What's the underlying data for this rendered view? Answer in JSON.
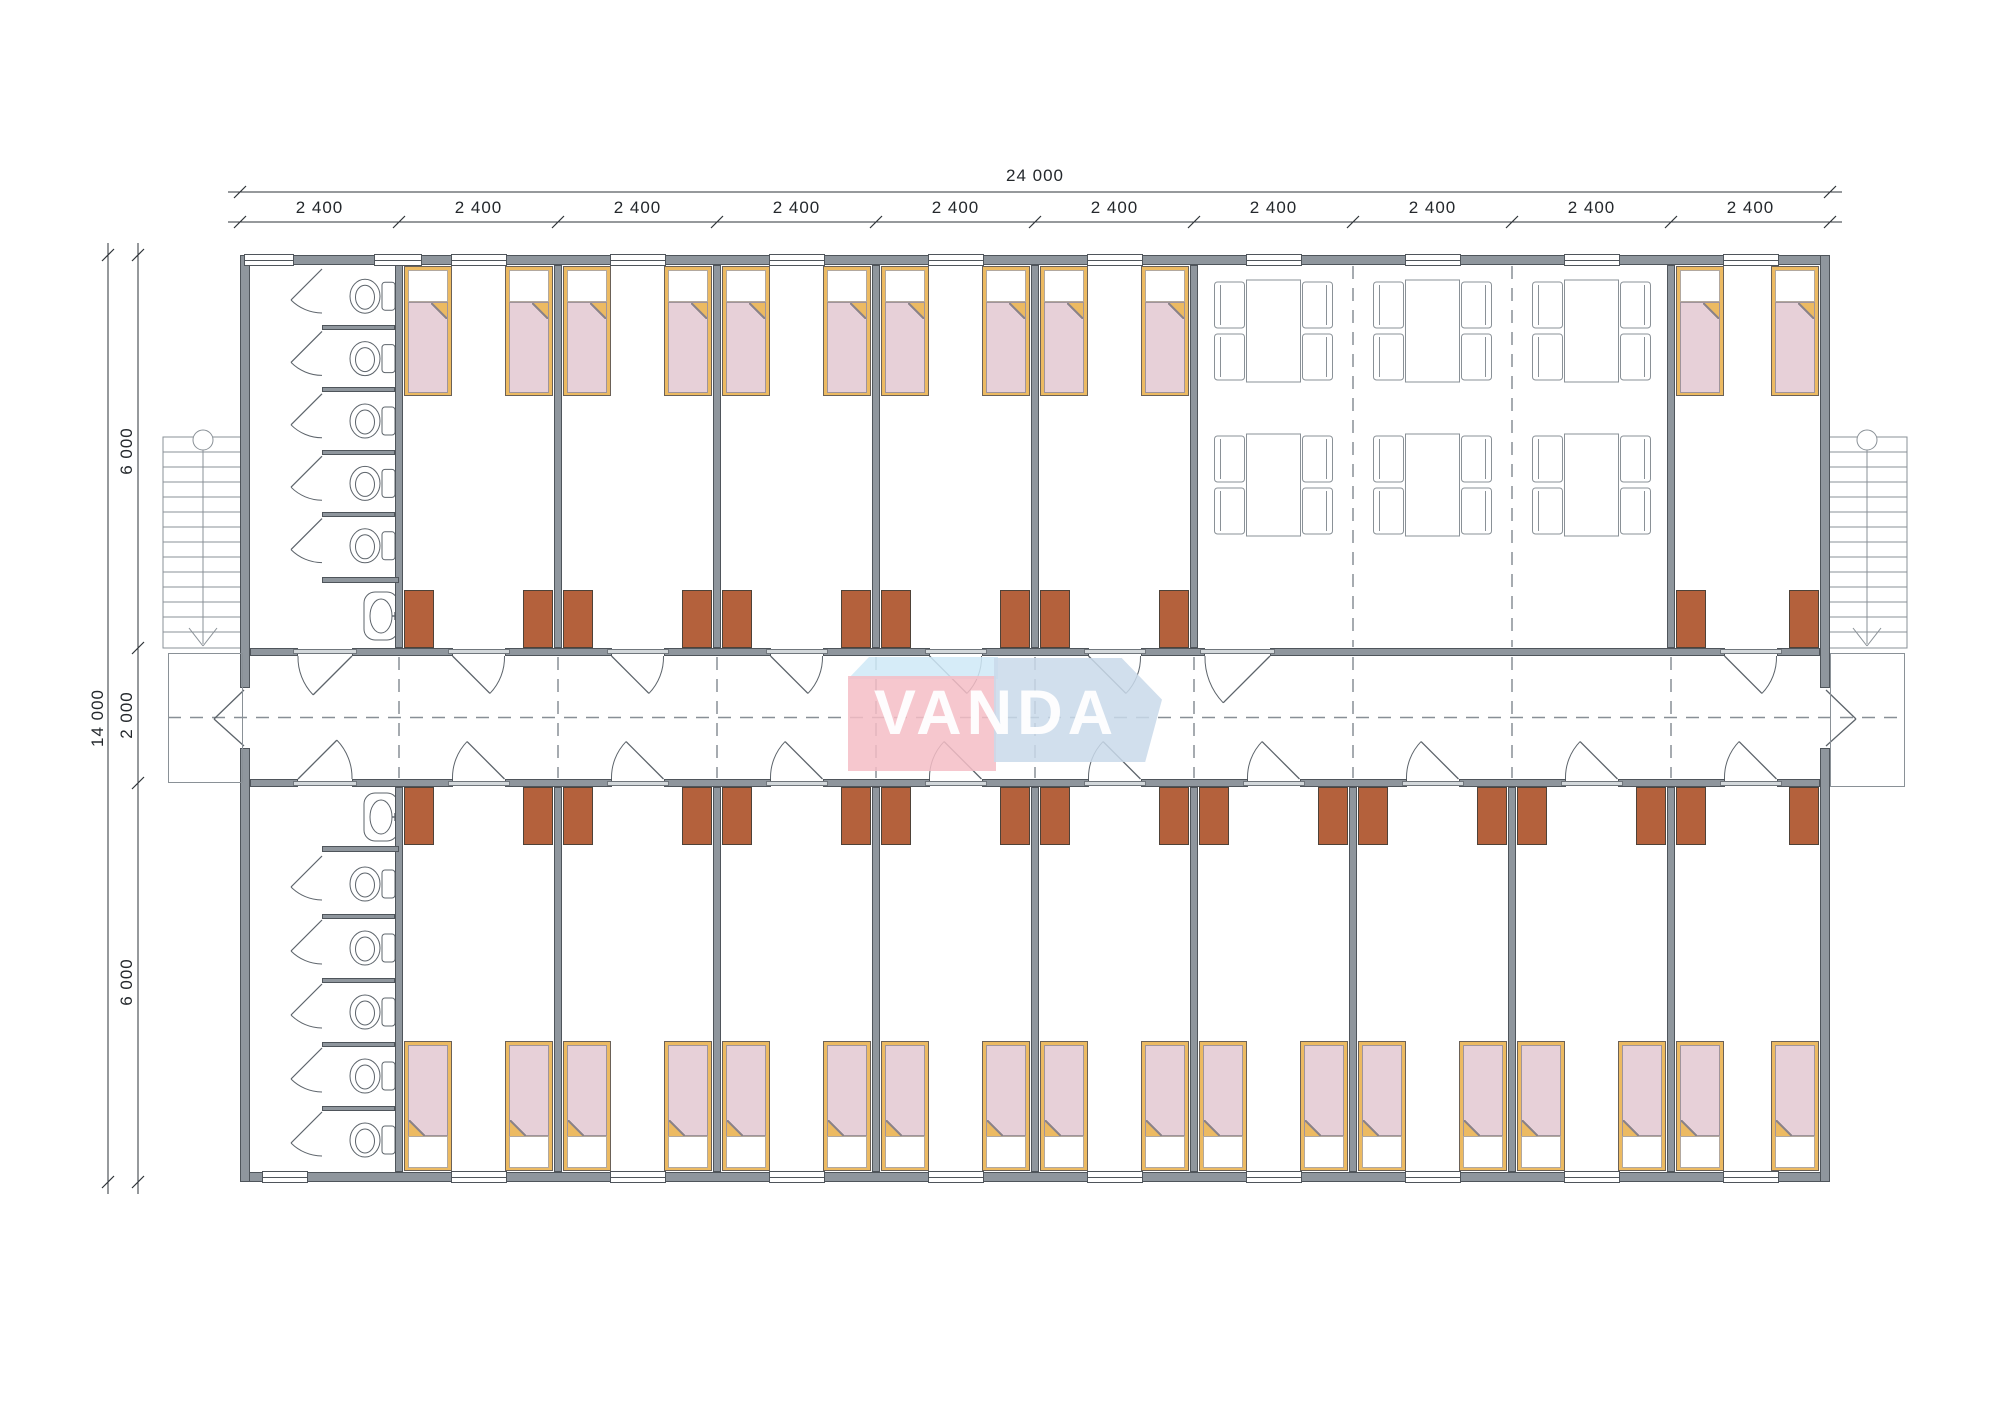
{
  "logo": {
    "text": "VANDA"
  },
  "dimensions": {
    "total_width": "24 000",
    "modules": [
      "2 400",
      "2 400",
      "2 400",
      "2 400",
      "2 400",
      "2 400",
      "2 400",
      "2 400",
      "2 400",
      "2 400"
    ],
    "total_height": "14 000",
    "bands": [
      "6 000",
      "2 000",
      "6 000"
    ]
  },
  "colors": {
    "wall_fill": "#8f969d",
    "wall_edge": "#4f555b",
    "thin_line": "#8a9197",
    "bed_frame": "#ecba62",
    "bed_edge": "#6b6157",
    "mattress": "#e7d0d8",
    "pillow": "#ffffff",
    "wardrobe": "#b4613c",
    "threshold": "#d3d8db",
    "door_line": "#5d646b",
    "dash_line": "#888f96",
    "dim_line": "#2e3338",
    "logo_pink": "#f5bdc5",
    "logo_blue": "#c9d9ea",
    "logo_sky": "#cfe9f7"
  },
  "plan": {
    "top_modules": [
      "bathroom",
      "bedroom",
      "bedroom",
      "bedroom",
      "bedroom",
      "bedroom",
      "dining",
      "dining",
      "dining",
      "bedroom"
    ],
    "bottom_modules": [
      "bathroom",
      "bedroom",
      "bedroom",
      "bedroom",
      "bedroom",
      "bedroom",
      "bedroom",
      "bedroom",
      "bedroom",
      "bedroom"
    ],
    "stalls_per_bathroom": 5,
    "beds_per_bedroom": 2,
    "wardrobes_per_bedroom": 2,
    "dining_tables": 6,
    "chairs_per_table": 4,
    "stairs": 2
  }
}
